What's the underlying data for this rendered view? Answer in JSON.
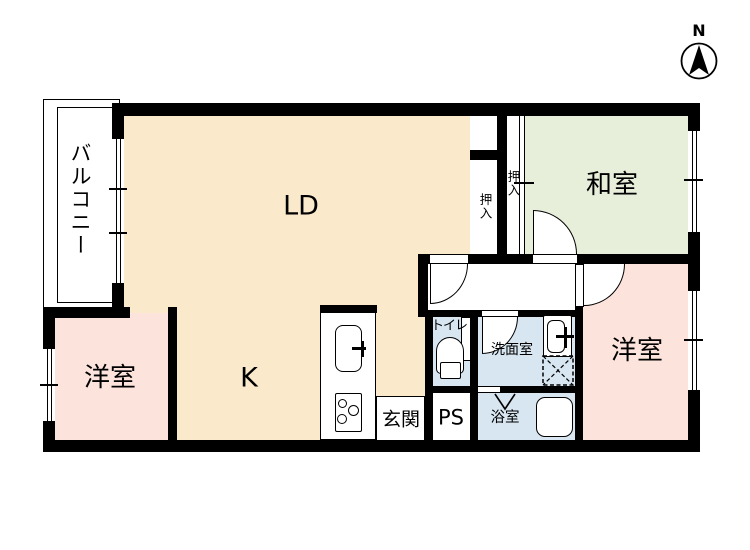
{
  "plan_title": "apartment floor plan",
  "compass": {
    "north": "N"
  },
  "rooms": {
    "living_dining": "LD",
    "kitchen": "K",
    "japanese_room": "和室",
    "western_room_right": "洋室",
    "western_room_left": "洋室",
    "balcony": "バルコニー",
    "toilet": "トイレ",
    "washroom": "洗面室",
    "bathroom": "浴室",
    "pipe_space": "PS",
    "entrance": "玄関",
    "closet_ld": "押入",
    "closet_washitsu": "押入"
  },
  "colors": {
    "wall": "#000000",
    "ldk_floor": "#fae9cb",
    "japanese_room_floor": "#e7efda",
    "western_room_floor": "#fce4dc",
    "wet_area_floor": "#d7e6f1",
    "background": "#ffffff"
  }
}
